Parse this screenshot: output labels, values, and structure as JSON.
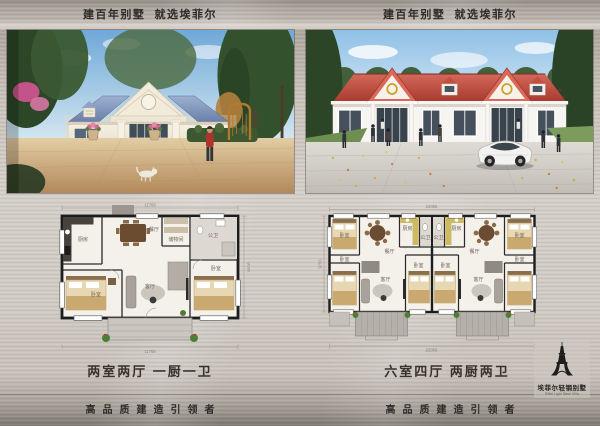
{
  "panels": {
    "left": {
      "header": "建百年别墅  就选埃菲尔",
      "caption": "两室两厅 一厨一卫",
      "footer": "高品质建造引领者",
      "plan": {
        "dims": {
          "top": "11768",
          "bottom": "11768",
          "side": "9168"
        },
        "rooms": {
          "kitchen": "厨房",
          "dining": "餐厅",
          "storage": "储物间",
          "bath": "公卫",
          "bedroom_left": "卧室",
          "living": "客厅",
          "bedroom_right": "卧室"
        }
      }
    },
    "right": {
      "header": "建百年别墅  就选埃菲尔",
      "caption": "六室四厅 两厨两卫",
      "footer": "高品质建造引领者",
      "plan": {
        "dims": {
          "top": "22056",
          "bottom": "22056",
          "side": "9756"
        },
        "rooms": {
          "bedroom_a": "卧室",
          "dining": "餐厅",
          "kitchen": "厨房",
          "bath": "公卫",
          "bedroom_b": "卧室",
          "living": "客厅",
          "bedroom_c": "卧室"
        }
      }
    }
  },
  "logo": {
    "cn": "埃菲尔轻钢别墅",
    "en": "Eiffel Light Steel Villa"
  },
  "colors": {
    "metal_base": "#cdc8c1",
    "header_text": "#2e2b28",
    "roof_blue": "#7f96bd",
    "roof_red": "#c2473a",
    "plan_wall": "#1d1d1d",
    "logo_black": "#1f1d1b"
  }
}
